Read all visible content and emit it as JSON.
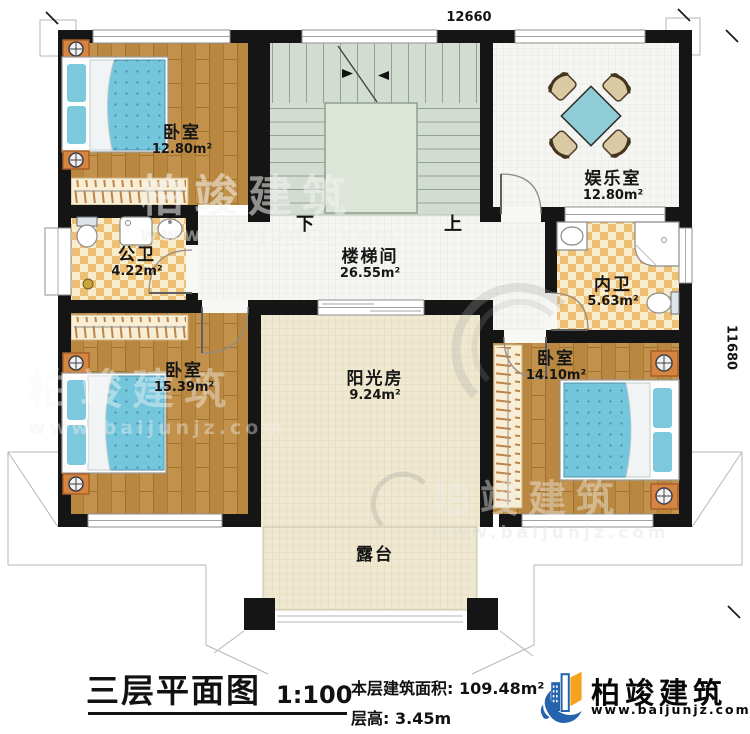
{
  "plan": {
    "dimensions": {
      "top_width": "12660",
      "right_height": "11680"
    },
    "stairs": {
      "down_label": "下",
      "up_label": "上"
    },
    "rooms": [
      {
        "name": "卧室",
        "area": "12.80m²"
      },
      {
        "name": "娱乐室",
        "area": "12.80m²"
      },
      {
        "name": "楼梯间",
        "area": "26.55m²"
      },
      {
        "name": "公卫",
        "area": "4.22m²"
      },
      {
        "name": "内卫",
        "area": "5.63m²"
      },
      {
        "name": "卧室",
        "area": "15.39m²"
      },
      {
        "name": "卧室",
        "area": "14.10m²"
      },
      {
        "name": "阳光房",
        "area": "9.24m²"
      },
      {
        "name": "露台",
        "area": ""
      }
    ]
  },
  "title_block": {
    "title": "三层平面图",
    "scale": "1:100",
    "floor_area_label": "本层建筑面积:",
    "floor_area_value": "109.48m²",
    "floor_height_label": "层高:",
    "floor_height_value": "3.45m"
  },
  "brand": {
    "name": "柏竣建筑",
    "website": "www.baijunjz.com"
  },
  "watermark": {
    "name": "柏竣建筑",
    "website": "www.baijunjz.com"
  },
  "colors": {
    "wall": "#151515",
    "wood": "#b9873f",
    "mattress": "#74c6dc",
    "stair_floor": "#d3dcd1",
    "checker": "#edc076",
    "cream_tile": "#f0e9d1",
    "brand_blue": "#2563ad",
    "accent_orange": "#f5a21c"
  }
}
